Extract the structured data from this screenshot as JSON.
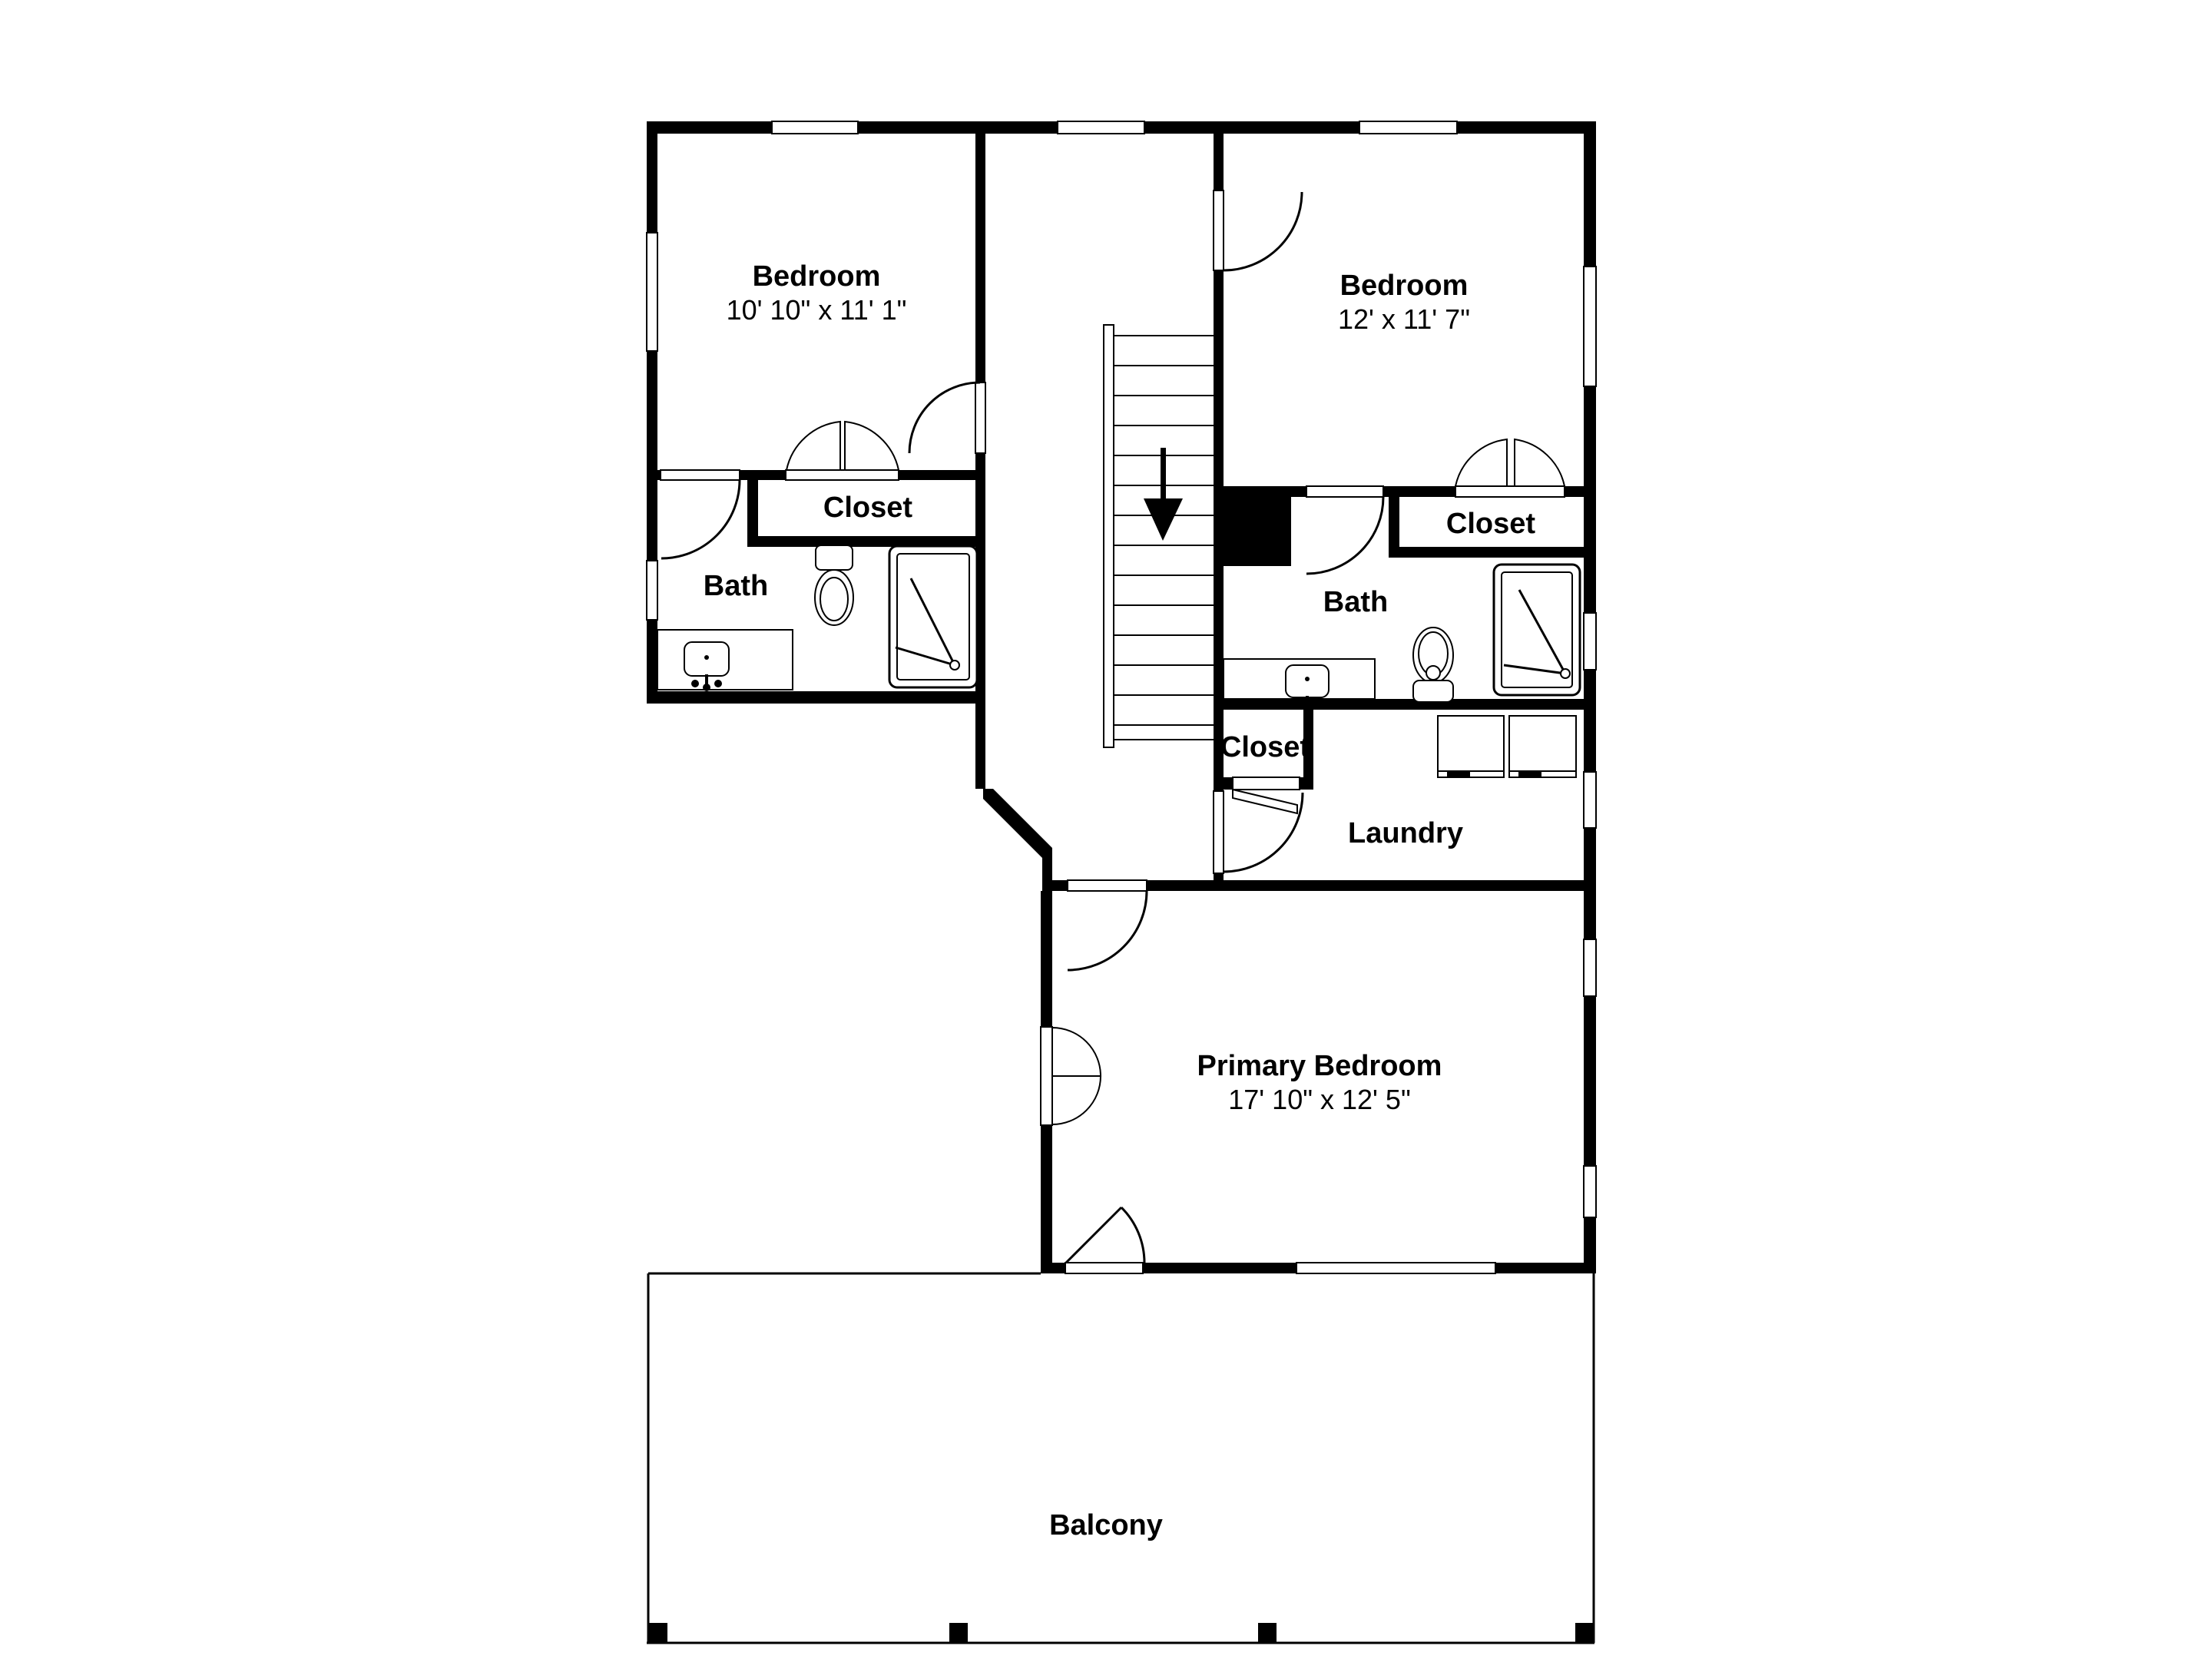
{
  "rooms": {
    "bedroom1": {
      "name": "Bedroom",
      "dims": "10' 10\" x 11' 1\""
    },
    "bedroom2": {
      "name": "Bedroom",
      "dims": "12' x 11' 7\""
    },
    "closet1": {
      "name": "Closet"
    },
    "bath1": {
      "name": "Bath"
    },
    "closet2": {
      "name": "Closet"
    },
    "bath2": {
      "name": "Bath"
    },
    "closet3": {
      "name": "Closet"
    },
    "laundry": {
      "name": "Laundry"
    },
    "primary": {
      "name": "Primary Bedroom",
      "dims": "17' 10\" x 12' 5\""
    },
    "balcony": {
      "name": "Balcony"
    }
  },
  "colors": {
    "wall": "#000000",
    "background": "#ffffff",
    "line": "#000000"
  }
}
